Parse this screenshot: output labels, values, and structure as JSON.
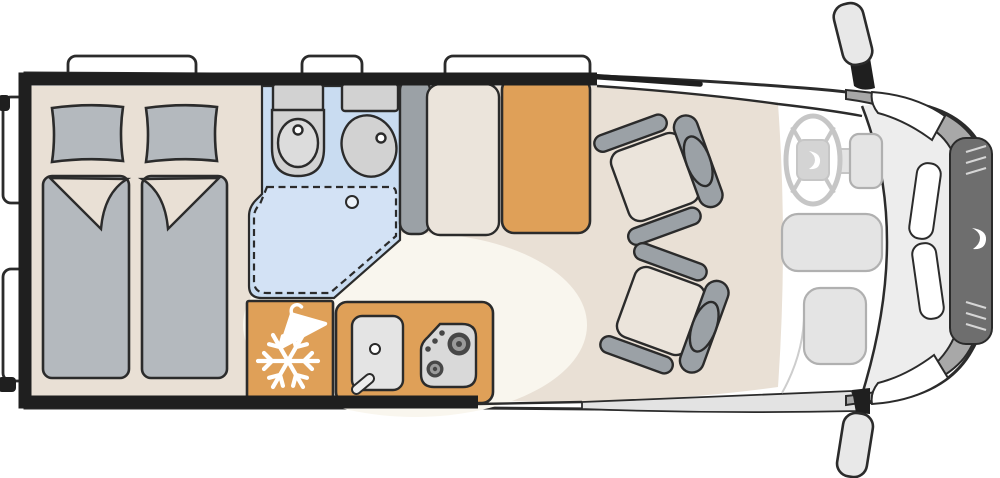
{
  "diagram": {
    "type": "motorhome-floorplan",
    "description": "Top-down floor plan of a camper van: rear twin beds, corner washroom with shower, kitchenette with fridge, sink and hob, side dinette with table, two swivel cab seats, driver cab with steering wheel",
    "icons": [
      "snowflake-icon",
      "clothes-hanger-icon",
      "steering-wheel-icon",
      "brand-swirl-logo",
      "burner-icon",
      "drain-icon"
    ],
    "elements": {
      "windows": 5,
      "beds": 2,
      "pillows": 2,
      "swivel_seats": 2,
      "mirrors": 2,
      "burners": 2
    },
    "palette": {
      "wall": "#1f1f1f",
      "outline": "#2b2b2b",
      "body_white": "#ffffff",
      "floor_beige": "#e9e0d5",
      "floor_cream": "#f9f6ee",
      "accent_orange": "#dfa058",
      "wetroom_blue": "#c9dcf1",
      "shower_blue": "#d3e2f5",
      "textile_gray": "#b4b9be",
      "fixture_gray": "#d2d2d2",
      "fixture_inner": "#dcdcdc",
      "drain_fill": "#eef4fb",
      "seat_cushion": "#ebe4db",
      "seat_gray": "#9ba1a6",
      "stove_gray": "#d9d9d9",
      "burner_dark": "#474747",
      "burner_mid": "#9a9a9a",
      "nose_light": "#ededed",
      "cab_band_gray": "#a8a8a8",
      "cab_panel_dark": "#6e6e6e",
      "dash_fill": "#e4e4e4",
      "dash_stroke": "#b0b0b0",
      "wheel_stroke": "#c6c6c6",
      "hub_gray": "#d4d4d4",
      "mirror_gray": "#e8e8e8",
      "skirt_gray": "#e3e3e3",
      "faint_line": "#cdcdcd",
      "panel_hatch": "#d6d6d6",
      "icon_white": "#ffffff"
    }
  }
}
